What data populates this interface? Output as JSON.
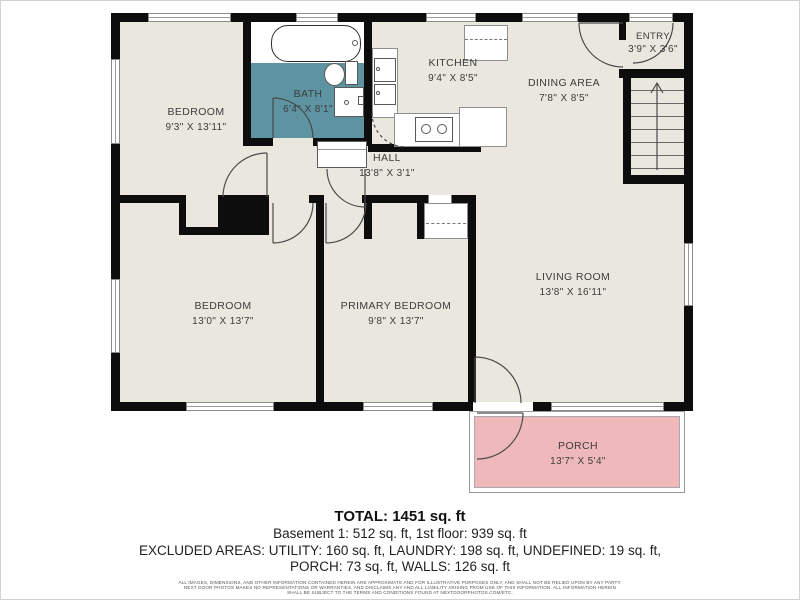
{
  "plan": {
    "type": "floor-plan"
  },
  "rooms": [
    {
      "id": "bedroom-1",
      "name": "BEDROOM",
      "dims": "9'3\" X 13'11\""
    },
    {
      "id": "bath",
      "name": "BATH",
      "dims": "6'4\" X 8'1\""
    },
    {
      "id": "kitchen",
      "name": "KITCHEN",
      "dims": "9'4\" X 8'5\""
    },
    {
      "id": "dining-area",
      "name": "DINING AREA",
      "dims": "7'8\" X 8'5\""
    },
    {
      "id": "entry",
      "name": "ENTRY",
      "dims": "3'9\" X 3'6\""
    },
    {
      "id": "hall",
      "name": "HALL",
      "dims": "13'8\" X 3'1\""
    },
    {
      "id": "bedroom-2",
      "name": "BEDROOM",
      "dims": "13'0\" X 13'7\""
    },
    {
      "id": "primary-bedroom",
      "name": "PRIMARY BEDROOM",
      "dims": "9'8\" X 13'7\""
    },
    {
      "id": "living-room",
      "name": "LIVING ROOM",
      "dims": "13'8\" X 16'11\""
    },
    {
      "id": "porch",
      "name": "PORCH",
      "dims": "13'7\" X 5'4\""
    }
  ],
  "summary": {
    "total": "TOTAL: 1451 sq. ft",
    "floors": "Basement 1: 512 sq. ft, 1st floor: 939 sq. ft",
    "excluded_line1": "EXCLUDED AREAS: UTILITY: 160 sq. ft, LAUNDRY: 198 sq. ft, UNDEFINED: 19 sq. ft,",
    "excluded_line2": "PORCH: 73 sq. ft, WALLS: 126 sq. ft"
  },
  "disclaimer": {
    "line1": "ALL IMAGES, DIMENSIONS, AND OTHER INFORMATION CONTAINED HEREIN ARE APPROXIMATE AND FOR ILLUSTRATIVE PURPOSES ONLY, AND SHALL NOT BE RELIED UPON BY ANY PARTY.",
    "line2": "NEXT DOOR PHOTOS MAKES NO REPRESENTATIONS OR WARRANTIES, AND DISCLAIMS ANY AND ALL LIABILITY ARISING FROM USE OF THIS INFORMATION. ALL INFORMATION HEREIN",
    "line3": "SHALL BE SUBJECT TO THE TERMS AND CONDITIONS FOUND AT NEXTDOORPHOTOS.COM/ETC."
  },
  "colors": {
    "floor": "#e9e7de",
    "bath": "#5e93a2",
    "porch": "#efb9bc",
    "wall": "#0d0d0d"
  }
}
